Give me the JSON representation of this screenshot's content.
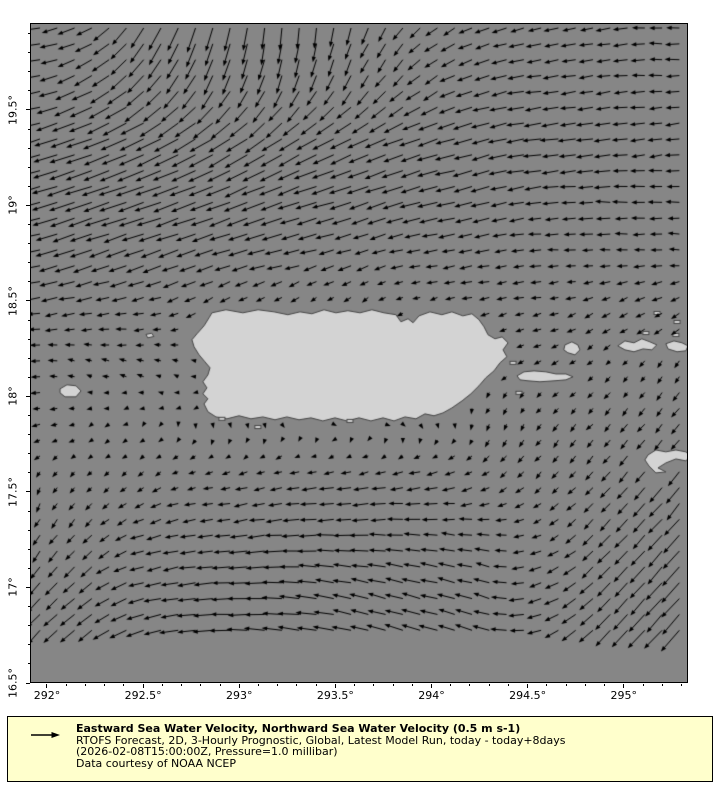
{
  "map": {
    "frame_px": {
      "left": 31,
      "top": 24,
      "width": 657,
      "height": 659
    },
    "lon_range": [
      291.917,
      295.334
    ],
    "lat_range": [
      16.5,
      19.95
    ],
    "colors": {
      "sea": "#868686",
      "land": "#d3d3d3",
      "coast": "#454545",
      "arrow": "#000000",
      "frame": "#000000",
      "legend_bg": "#ffffcc"
    },
    "x_axis": {
      "ticks": [
        {
          "value": 292.0,
          "label": "292°"
        },
        {
          "value": 292.5,
          "label": "292.5°"
        },
        {
          "value": 293.0,
          "label": "293°"
        },
        {
          "value": 293.5,
          "label": "293.5°"
        },
        {
          "value": 294.0,
          "label": "294°"
        },
        {
          "value": 294.5,
          "label": "294.5°"
        },
        {
          "value": 295.0,
          "label": "295°"
        }
      ],
      "minor_step": 0.1
    },
    "y_axis": {
      "ticks": [
        {
          "value": 16.5,
          "label": "16.5°"
        },
        {
          "value": 17.0,
          "label": "17°"
        },
        {
          "value": 17.5,
          "label": "17.5°"
        },
        {
          "value": 18.0,
          "label": "18°"
        },
        {
          "value": 18.5,
          "label": "18.5°"
        },
        {
          "value": 19.0,
          "label": "19°"
        },
        {
          "value": 19.5,
          "label": "19.5°"
        }
      ],
      "minor_step": 0.1
    },
    "land": {
      "polygons": [
        {
          "name": "puerto-rico",
          "pts": [
            [
              292.858,
              18.438
            ],
            [
              292.931,
              18.454
            ],
            [
              293.019,
              18.438
            ],
            [
              293.098,
              18.454
            ],
            [
              293.181,
              18.443
            ],
            [
              293.253,
              18.428
            ],
            [
              293.316,
              18.443
            ],
            [
              293.378,
              18.433
            ],
            [
              293.441,
              18.454
            ],
            [
              293.503,
              18.438
            ],
            [
              293.565,
              18.449
            ],
            [
              293.628,
              18.438
            ],
            [
              293.69,
              18.454
            ],
            [
              293.753,
              18.438
            ],
            [
              293.815,
              18.428
            ],
            [
              293.841,
              18.391
            ],
            [
              293.878,
              18.407
            ],
            [
              293.904,
              18.386
            ],
            [
              293.935,
              18.422
            ],
            [
              293.992,
              18.443
            ],
            [
              294.054,
              18.428
            ],
            [
              294.106,
              18.443
            ],
            [
              294.163,
              18.422
            ],
            [
              294.21,
              18.433
            ],
            [
              294.247,
              18.402
            ],
            [
              294.273,
              18.365
            ],
            [
              294.294,
              18.323
            ],
            [
              294.33,
              18.302
            ],
            [
              294.367,
              18.312
            ],
            [
              294.398,
              18.281
            ],
            [
              294.372,
              18.244
            ],
            [
              294.392,
              18.208
            ],
            [
              294.356,
              18.176
            ],
            [
              294.325,
              18.134
            ],
            [
              294.283,
              18.098
            ],
            [
              294.247,
              18.056
            ],
            [
              294.205,
              18.014
            ],
            [
              294.159,
              17.977
            ],
            [
              294.106,
              17.94
            ],
            [
              294.06,
              17.914
            ],
            [
              294.013,
              17.899
            ],
            [
              293.966,
              17.909
            ],
            [
              293.919,
              17.883
            ],
            [
              293.862,
              17.893
            ],
            [
              293.805,
              17.872
            ],
            [
              293.748,
              17.888
            ],
            [
              293.685,
              17.872
            ],
            [
              293.623,
              17.888
            ],
            [
              293.56,
              17.872
            ],
            [
              293.498,
              17.888
            ],
            [
              293.435,
              17.872
            ],
            [
              293.373,
              17.888
            ],
            [
              293.311,
              17.878
            ],
            [
              293.248,
              17.893
            ],
            [
              293.186,
              17.878
            ],
            [
              293.123,
              17.893
            ],
            [
              293.061,
              17.883
            ],
            [
              292.999,
              17.899
            ],
            [
              292.936,
              17.883
            ],
            [
              292.879,
              17.893
            ],
            [
              292.837,
              17.92
            ],
            [
              292.817,
              17.961
            ],
            [
              292.837,
              17.988
            ],
            [
              292.811,
              18.014
            ],
            [
              292.832,
              18.045
            ],
            [
              292.811,
              18.077
            ],
            [
              292.837,
              18.113
            ],
            [
              292.848,
              18.15
            ],
            [
              292.822,
              18.181
            ],
            [
              292.791,
              18.218
            ],
            [
              292.765,
              18.26
            ],
            [
              292.754,
              18.297
            ],
            [
              292.78,
              18.328
            ],
            [
              292.817,
              18.37
            ],
            [
              292.843,
              18.412
            ]
          ]
        },
        {
          "name": "mona-island",
          "pts": [
            [
              292.068,
              18.04
            ],
            [
              292.104,
              18.061
            ],
            [
              292.151,
              18.056
            ],
            [
              292.177,
              18.029
            ],
            [
              292.151,
              17.998
            ],
            [
              292.094,
              17.998
            ],
            [
              292.068,
              18.019
            ]
          ]
        },
        {
          "name": "desecheo-island",
          "pts": [
            [
              292.515,
              18.325
            ],
            [
              292.545,
              18.331
            ],
            [
              292.556,
              18.314
            ],
            [
              292.524,
              18.307
            ]
          ]
        },
        {
          "name": "vieques",
          "pts": [
            [
              294.445,
              18.108
            ],
            [
              294.481,
              18.129
            ],
            [
              294.533,
              18.134
            ],
            [
              294.595,
              18.129
            ],
            [
              294.647,
              18.118
            ],
            [
              294.699,
              18.118
            ],
            [
              294.736,
              18.103
            ],
            [
              294.699,
              18.087
            ],
            [
              294.637,
              18.082
            ],
            [
              294.564,
              18.077
            ],
            [
              294.502,
              18.082
            ],
            [
              294.46,
              18.087
            ]
          ]
        },
        {
          "name": "culebra",
          "pts": [
            [
              294.694,
              18.27
            ],
            [
              294.73,
              18.286
            ],
            [
              294.761,
              18.27
            ],
            [
              294.772,
              18.244
            ],
            [
              294.746,
              18.218
            ],
            [
              294.709,
              18.229
            ],
            [
              294.688,
              18.244
            ]
          ]
        },
        {
          "name": "st-thomas",
          "pts": [
            [
              294.969,
              18.265
            ],
            [
              295.006,
              18.291
            ],
            [
              295.053,
              18.281
            ],
            [
              295.094,
              18.302
            ],
            [
              295.136,
              18.286
            ],
            [
              295.172,
              18.27
            ],
            [
              295.146,
              18.244
            ],
            [
              295.1,
              18.249
            ],
            [
              295.053,
              18.234
            ],
            [
              295.006,
              18.244
            ]
          ]
        },
        {
          "name": "st-john",
          "pts": [
            [
              295.219,
              18.276
            ],
            [
              295.261,
              18.291
            ],
            [
              295.303,
              18.281
            ],
            [
              295.334,
              18.265
            ],
            [
              295.323,
              18.239
            ],
            [
              295.277,
              18.234
            ],
            [
              295.23,
              18.249
            ]
          ]
        },
        {
          "name": "st-croix",
          "pts": [
            [
              295.126,
              17.694
            ],
            [
              295.167,
              17.72
            ],
            [
              295.219,
              17.71
            ],
            [
              295.271,
              17.72
            ],
            [
              295.323,
              17.71
            ],
            [
              295.349,
              17.689
            ],
            [
              295.323,
              17.663
            ],
            [
              295.271,
              17.673
            ],
            [
              295.219,
              17.652
            ],
            [
              295.178,
              17.626
            ],
            [
              295.219,
              17.605
            ],
            [
              295.167,
              17.6
            ],
            [
              295.131,
              17.636
            ],
            [
              295.11,
              17.668
            ]
          ]
        }
      ],
      "islets": [
        [
          295.115,
          18.332
        ],
        [
          295.271,
          18.322
        ],
        [
          295.173,
          18.437
        ],
        [
          295.277,
          18.39
        ],
        [
          294.424,
          18.176
        ],
        [
          294.455,
          18.019
        ],
        [
          292.91,
          17.883
        ],
        [
          293.576,
          17.872
        ],
        [
          293.097,
          17.84
        ]
      ]
    },
    "current_field": {
      "units": "m s-1",
      "reference_value": 0.5,
      "scale_px_per_unit": 46,
      "sample_grid": {
        "x0": 40,
        "dx": 17.28,
        "cols": 38,
        "y0": 28,
        "dy": 15.85,
        "rows": 39
      },
      "control_lons": [
        291.92,
        292.2,
        292.5,
        292.8,
        293.1,
        293.4,
        293.7,
        294.0,
        294.3,
        294.6,
        294.9,
        295.2,
        295.34
      ],
      "control_lats": [
        19.95,
        19.65,
        19.35,
        19.05,
        18.75,
        18.45,
        18.15,
        17.85,
        17.55,
        17.25,
        16.95,
        16.5
      ],
      "u": [
        [
          -0.35,
          -0.35,
          -0.3,
          -0.15,
          -0.05,
          -0.05,
          -0.15,
          -0.25,
          -0.3,
          -0.3,
          -0.3,
          -0.3,
          -0.3
        ],
        [
          -0.4,
          -0.4,
          -0.35,
          -0.25,
          -0.15,
          -0.15,
          -0.2,
          -0.3,
          -0.35,
          -0.35,
          -0.3,
          -0.3,
          -0.3
        ],
        [
          -0.5,
          -0.55,
          -0.55,
          -0.5,
          -0.45,
          -0.45,
          -0.45,
          -0.45,
          -0.4,
          -0.4,
          -0.35,
          -0.3,
          -0.3
        ],
        [
          -0.55,
          -0.6,
          -0.6,
          -0.55,
          -0.5,
          -0.5,
          -0.45,
          -0.45,
          -0.4,
          -0.35,
          -0.35,
          -0.3,
          -0.3
        ],
        [
          -0.45,
          -0.45,
          -0.45,
          -0.4,
          -0.4,
          -0.35,
          -0.3,
          -0.3,
          -0.3,
          -0.25,
          -0.25,
          -0.25,
          -0.25
        ],
        [
          -0.3,
          -0.3,
          -0.25,
          -0.2,
          -0.15,
          -0.1,
          -0.1,
          -0.15,
          -0.2,
          -0.2,
          -0.2,
          -0.2,
          -0.2
        ],
        [
          -0.2,
          -0.15,
          -0.15,
          -0.1,
          -0.1,
          -0.05,
          -0.05,
          -0.1,
          -0.1,
          -0.15,
          -0.1,
          -0.1,
          -0.1
        ],
        [
          -0.2,
          -0.1,
          -0.05,
          0.0,
          0.05,
          0.05,
          0.1,
          0.05,
          -0.05,
          -0.1,
          -0.15,
          -0.15,
          -0.2
        ],
        [
          -0.05,
          -0.1,
          -0.15,
          -0.2,
          -0.25,
          -0.3,
          -0.3,
          -0.3,
          -0.2,
          -0.15,
          -0.2,
          -0.25,
          -0.3
        ],
        [
          -0.15,
          -0.2,
          -0.3,
          -0.35,
          -0.4,
          -0.4,
          -0.4,
          -0.35,
          -0.3,
          -0.2,
          -0.25,
          -0.3,
          -0.35
        ],
        [
          -0.25,
          -0.3,
          -0.35,
          -0.4,
          -0.45,
          -0.45,
          -0.4,
          -0.4,
          -0.35,
          -0.3,
          -0.3,
          -0.35,
          -0.4
        ],
        [
          -0.3,
          -0.35,
          -0.4,
          -0.45,
          -0.45,
          -0.45,
          -0.4,
          -0.4,
          -0.35,
          -0.3,
          -0.35,
          -0.4,
          -0.4
        ]
      ],
      "v": [
        [
          -0.02,
          -0.15,
          -0.45,
          -0.55,
          -0.5,
          -0.45,
          -0.35,
          -0.2,
          -0.1,
          -0.05,
          -0.05,
          0.0,
          0.0
        ],
        [
          -0.05,
          -0.2,
          -0.35,
          -0.4,
          -0.4,
          -0.35,
          -0.3,
          -0.2,
          -0.1,
          -0.05,
          -0.05,
          0.0,
          0.0
        ],
        [
          -0.15,
          -0.2,
          -0.25,
          -0.3,
          -0.3,
          -0.25,
          -0.2,
          -0.15,
          -0.1,
          -0.05,
          -0.05,
          -0.05,
          -0.05
        ],
        [
          -0.15,
          -0.2,
          -0.2,
          -0.2,
          -0.2,
          -0.15,
          -0.15,
          -0.1,
          -0.1,
          -0.05,
          0.0,
          0.0,
          0.0
        ],
        [
          -0.1,
          -0.15,
          -0.15,
          -0.15,
          -0.1,
          -0.1,
          -0.1,
          -0.05,
          -0.05,
          0.0,
          0.0,
          0.0,
          0.0
        ],
        [
          -0.05,
          -0.05,
          -0.05,
          -0.1,
          -0.1,
          -0.1,
          -0.1,
          -0.05,
          -0.05,
          -0.05,
          -0.1,
          -0.1,
          -0.1
        ],
        [
          0.0,
          0.05,
          0.05,
          0.05,
          0.0,
          -0.05,
          -0.05,
          -0.05,
          -0.1,
          -0.1,
          -0.1,
          -0.15,
          -0.15
        ],
        [
          -0.05,
          -0.05,
          -0.05,
          -0.1,
          -0.1,
          -0.05,
          -0.05,
          -0.1,
          -0.15,
          -0.15,
          -0.15,
          -0.2,
          -0.2
        ],
        [
          -0.15,
          -0.1,
          -0.1,
          -0.05,
          -0.05,
          -0.05,
          -0.05,
          -0.05,
          -0.1,
          -0.15,
          -0.2,
          -0.3,
          -0.35
        ],
        [
          -0.25,
          -0.2,
          -0.1,
          -0.05,
          -0.05,
          0.0,
          0.0,
          0.05,
          0.05,
          -0.1,
          -0.25,
          -0.35,
          -0.4
        ],
        [
          -0.3,
          -0.25,
          -0.1,
          -0.05,
          0.0,
          0.05,
          0.1,
          0.1,
          0.1,
          -0.1,
          -0.3,
          -0.4,
          -0.45
        ],
        [
          -0.35,
          -0.3,
          -0.15,
          -0.05,
          0.05,
          0.1,
          0.15,
          0.15,
          0.1,
          -0.15,
          -0.35,
          -0.45,
          -0.5
        ]
      ]
    }
  },
  "legend": {
    "title": "Eastward Sea Water Velocity, Northward Sea Water Velocity (0.5 m s-1)",
    "line2": "RTOFS Forecast, 2D, 3-Hourly Prognostic, Global, Latest Model Run, today - today+8days",
    "line3": "(2026-02-08T15:00:00Z, Pressure=1.0 millibar)",
    "line4": "Data courtesy of NOAA NCEP",
    "reference_arrow_value": "0.5 m s-1"
  }
}
